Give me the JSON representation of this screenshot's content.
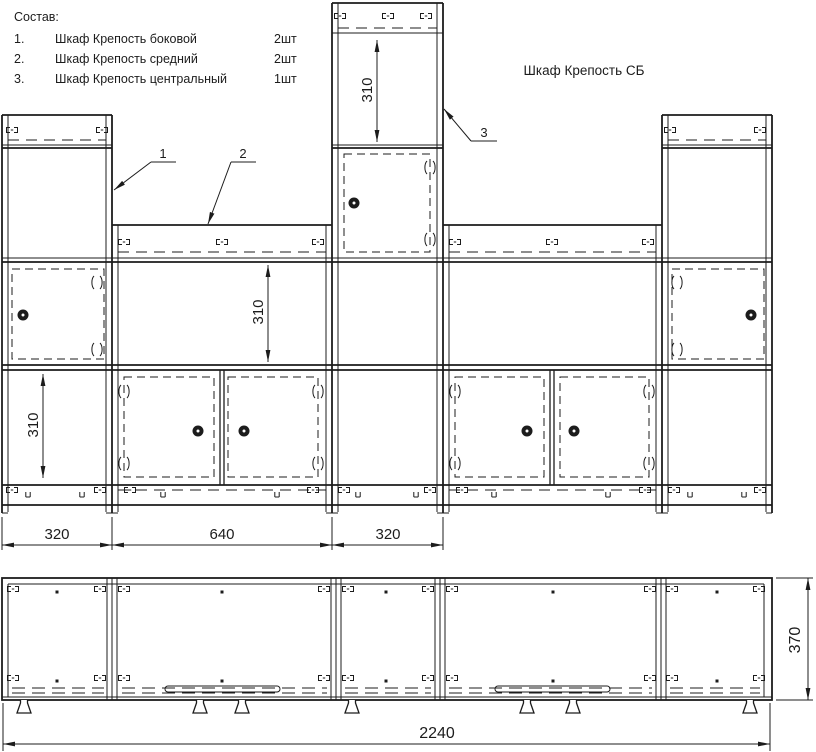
{
  "drawing": {
    "title": "Шкаф Крепость СБ",
    "parts_list": {
      "header": "Состав:",
      "items": [
        {
          "num": "1.",
          "name": "Шкаф Крепость боковой",
          "qty": "2шт"
        },
        {
          "num": "2.",
          "name": "Шкаф Крепость средний",
          "qty": "2шт"
        },
        {
          "num": "3.",
          "name": "Шкаф Крепость центральный",
          "qty": "1шт"
        }
      ]
    },
    "callouts": {
      "side_cabinet": "1",
      "middle_cabinet": "2",
      "central_cabinet": "3"
    },
    "dimensions": {
      "front": {
        "top_opening_height": "310",
        "middle_opening_height": "310",
        "bottom_opening_height": "310",
        "side_module_width": "320",
        "middle_module_width": "640",
        "central_module_width": "320"
      },
      "plan": {
        "total_width": "2240",
        "depth": "370"
      }
    },
    "colors": {
      "line": "#1c1c1c",
      "background": "#ffffff"
    }
  }
}
